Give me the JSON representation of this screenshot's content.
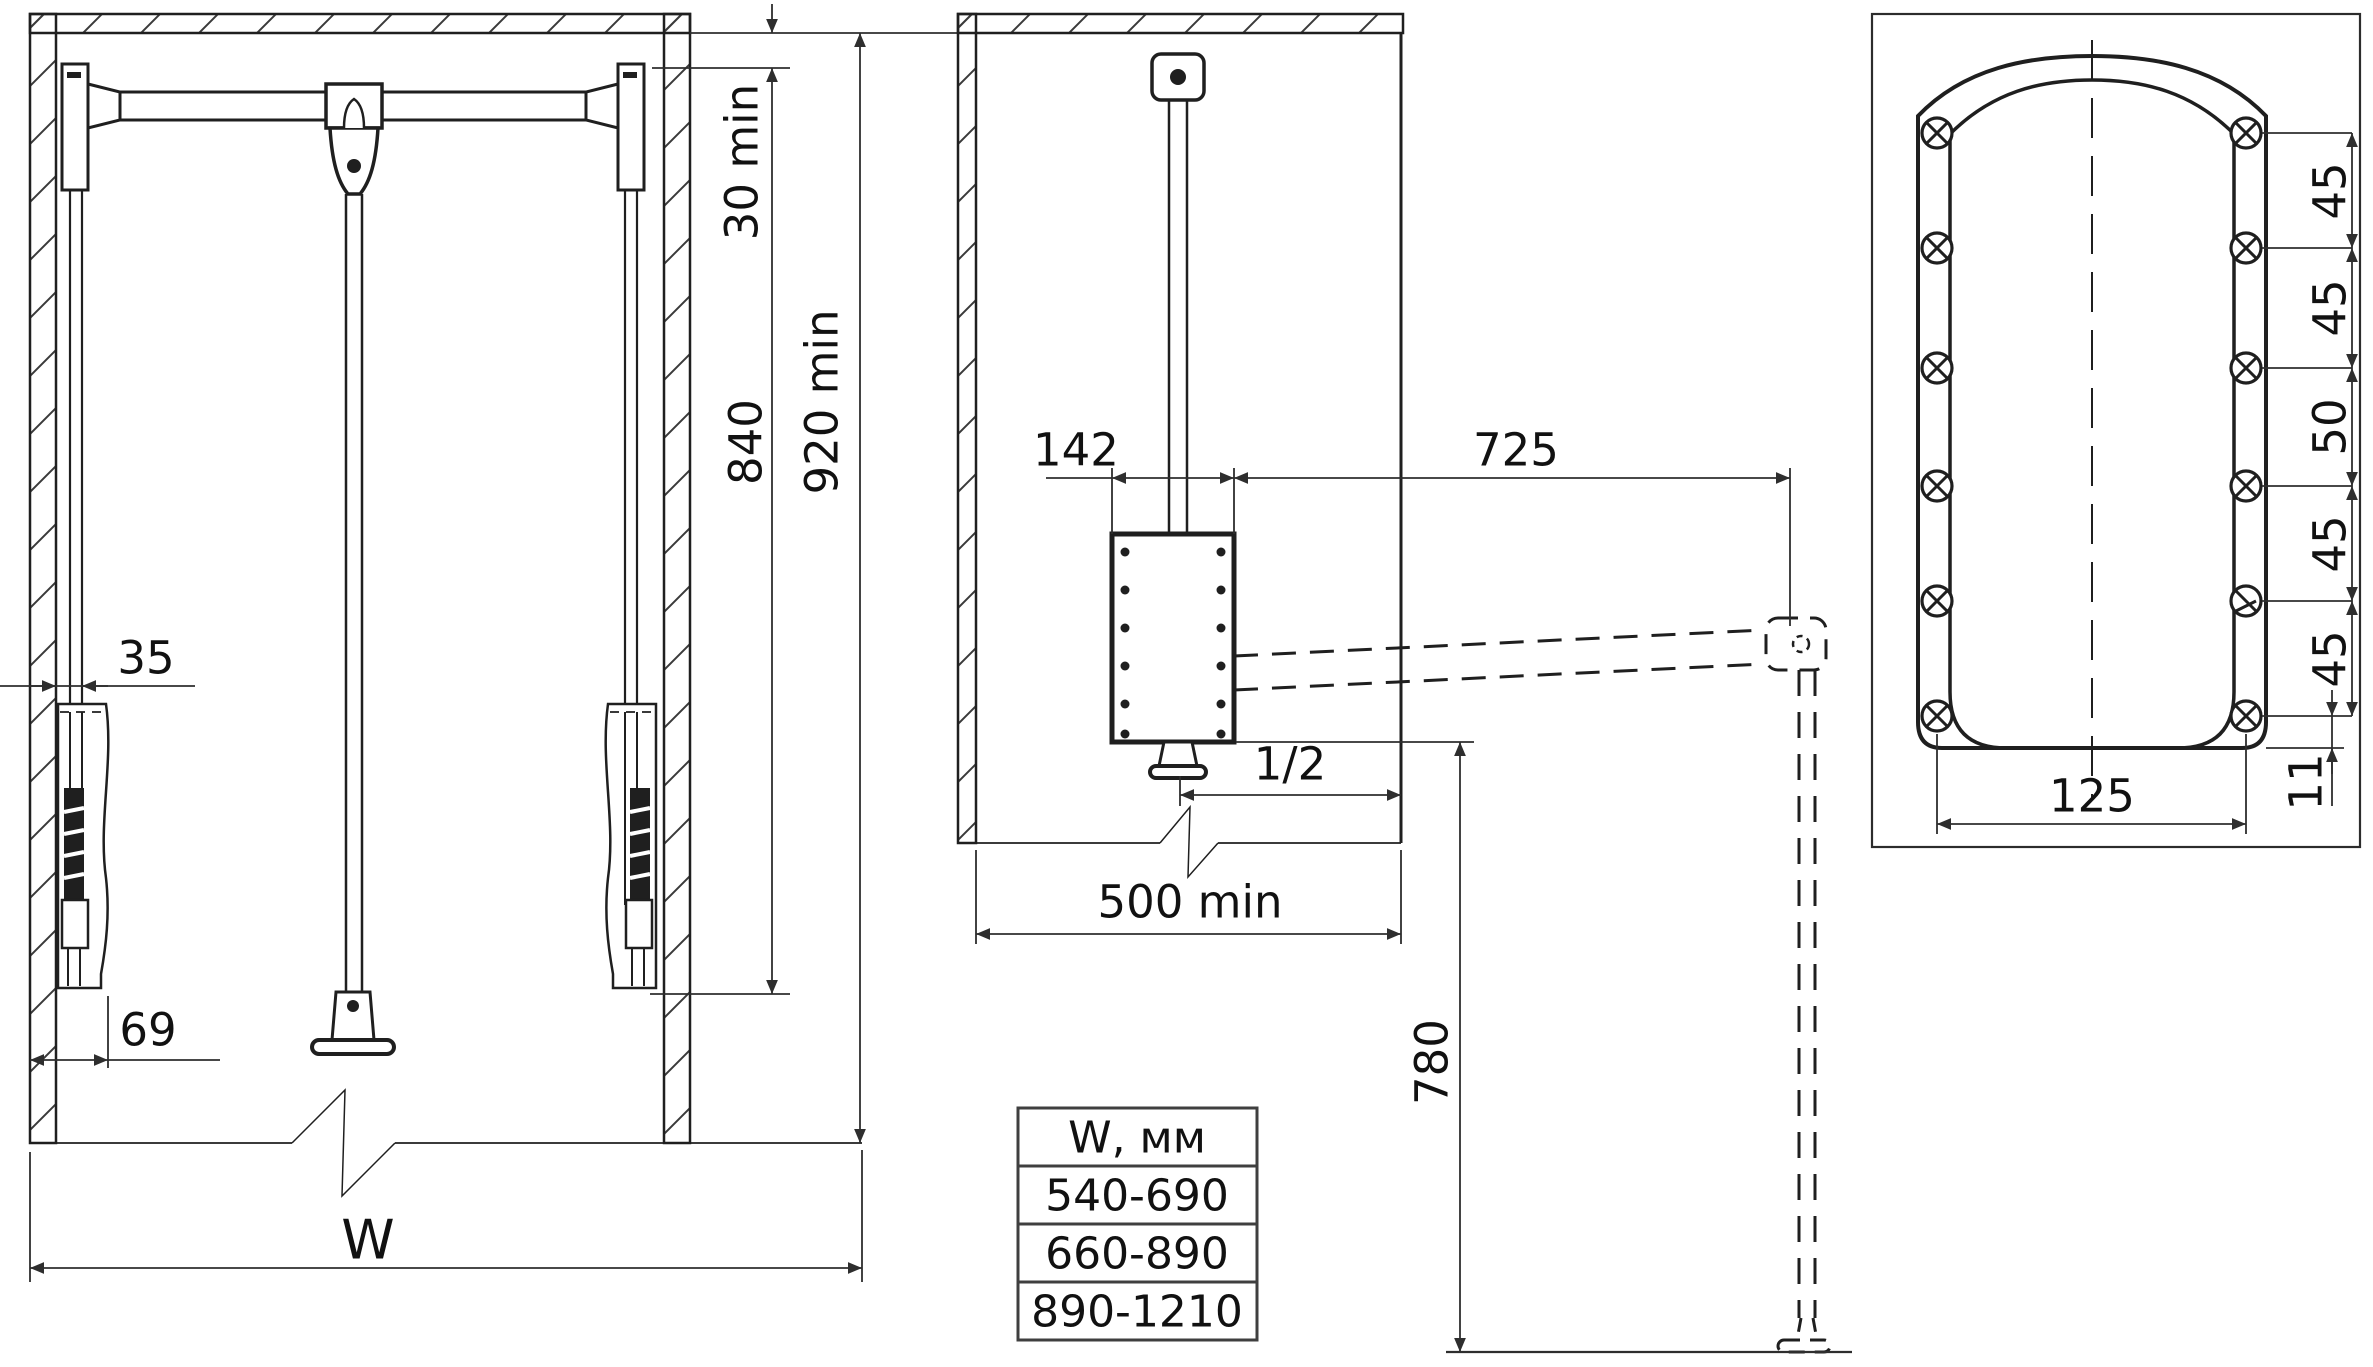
{
  "drawing": {
    "front_view": {
      "dims": {
        "ceiling_gap": "30 min",
        "bar_travel": "840",
        "cabinet_height": "920 min",
        "wall_offset": "35",
        "mechanism_offset": "69",
        "cabinet_width": "W"
      }
    },
    "side_view": {
      "dims": {
        "housing_width": "142",
        "arm_reach": "725",
        "half_width": "1/2",
        "cabinet_depth": "500 min",
        "lowered_drop": "780"
      }
    },
    "plate_view": {
      "dims": {
        "screw_spacing": [
          "45",
          "45",
          "50",
          "45",
          "45"
        ],
        "plate_width": "125",
        "edge_offset": "11"
      }
    },
    "width_table": {
      "header": "W, мм",
      "rows": [
        "540-690",
        "660-890",
        "890-1210"
      ]
    },
    "colors": {
      "background": "#ffffff",
      "line": "#1f1f1f",
      "dimension": "#2e2e2e",
      "table_border": "#3f3f3f"
    }
  }
}
